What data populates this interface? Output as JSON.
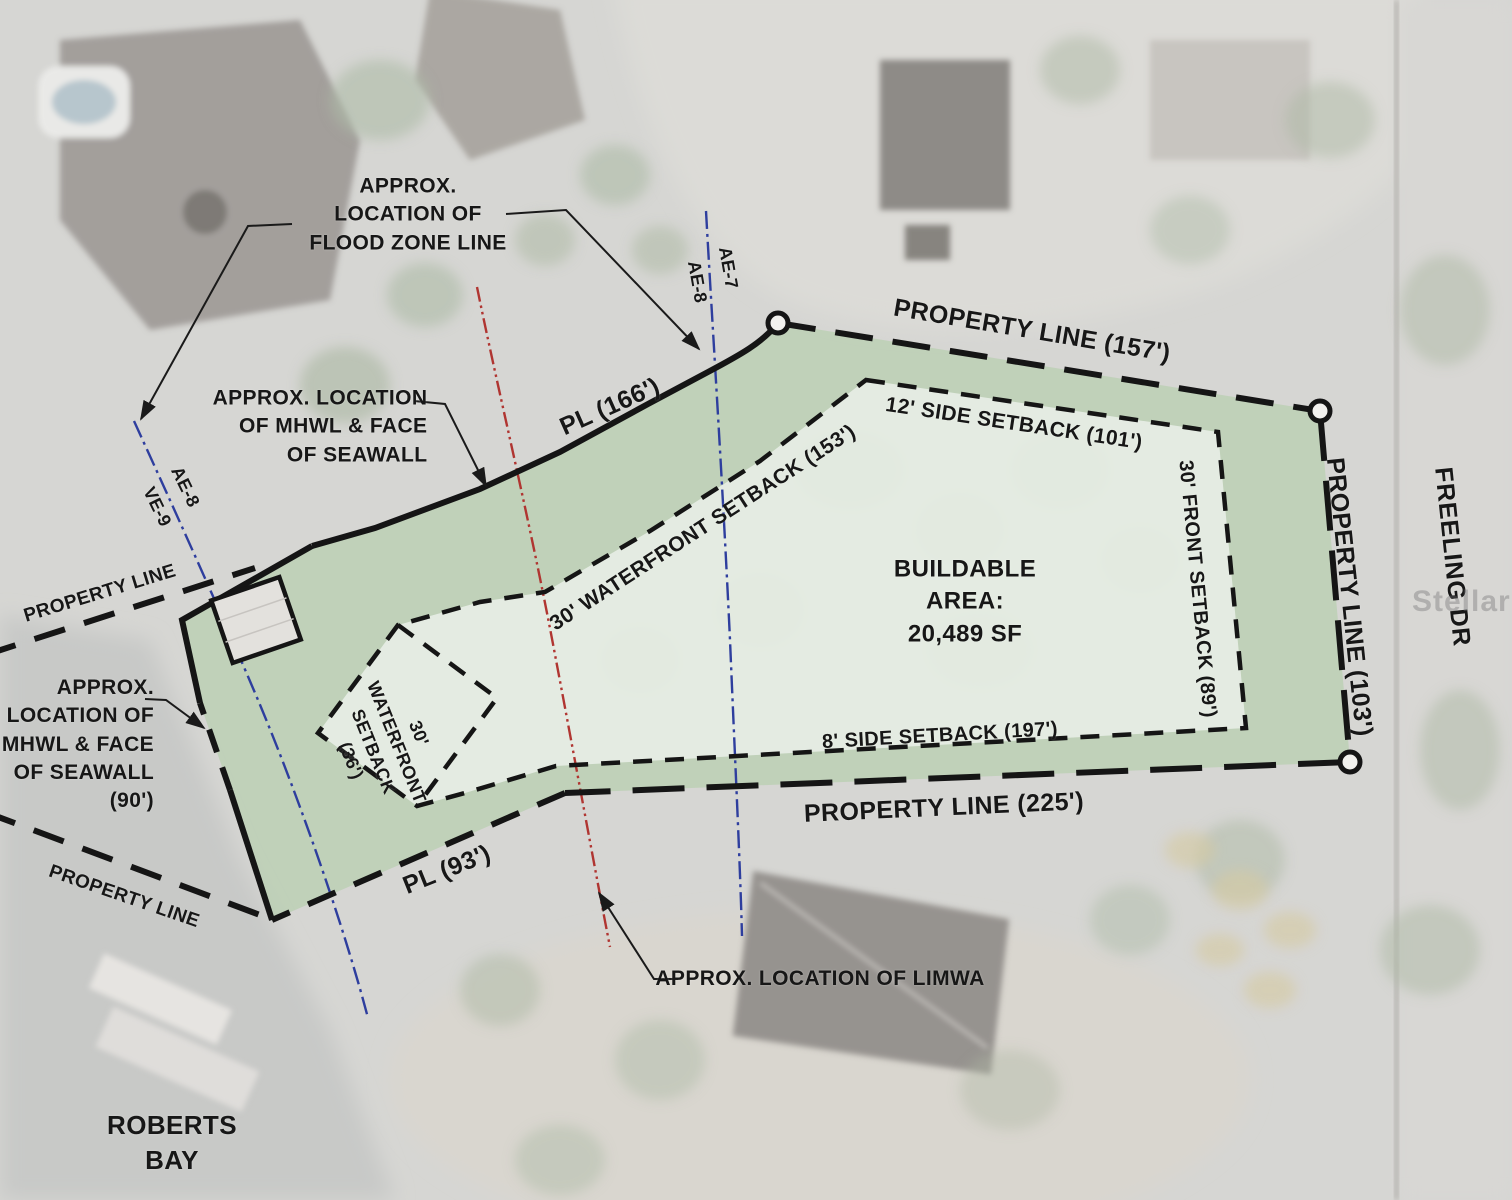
{
  "watermark": "Stellar MLS",
  "site_plan": {
    "buildable_area": {
      "lines": [
        "BUILDABLE",
        "AREA:",
        "20,489 SF"
      ]
    },
    "property_lines": {
      "north": "PROPERTY LINE (157')",
      "east": "PROPERTY LINE (103')",
      "south": "PROPERTY LINE (225')",
      "waterfront_north": "PL (166')",
      "waterfront_south": "PL (93')",
      "extension_upper_west": "PROPERTY LINE",
      "extension_lower_west": "PROPERTY LINE"
    },
    "setbacks": {
      "side_north": "12' SIDE SETBACK (101')",
      "front_east": "30' FRONT SETBACK (89')",
      "side_south": "8' SIDE SETBACK (197')",
      "waterfront_long": "30' WATERFRONT SETBACK (153')",
      "waterfront_short_lines": [
        "30'",
        "WATERFRONT",
        "SETBACK",
        "(36')"
      ]
    },
    "flood_zones": {
      "upper_line": [
        "AE-7",
        "AE-8"
      ],
      "lower_line": [
        "AE-8",
        "VE-9"
      ]
    },
    "callouts": {
      "flood_zone_lines": [
        "APPROX.",
        "LOCATION OF",
        "FLOOD ZONE LINE"
      ],
      "mhwl_north_lines": [
        "APPROX. LOCATION",
        "OF MHWL & FACE",
        "OF SEAWALL"
      ],
      "mhwl_south_lines": [
        "APPROX.",
        "LOCATION OF",
        "MHWL & FACE",
        "OF SEAWALL",
        "(90')"
      ],
      "limwa": "APPROX. LOCATION OF LIMWA"
    },
    "place_labels": {
      "bay_lines": [
        "ROBERTS",
        "BAY"
      ],
      "street": "FREELING DR"
    },
    "colors": {
      "parcel_green": "#c8dcc2",
      "buildable_fill": "#e9efe5",
      "boundary_line": "#151515",
      "flood_zone_line_blue": "#2e3e9e",
      "limwa_line_red": "#b03531"
    }
  }
}
